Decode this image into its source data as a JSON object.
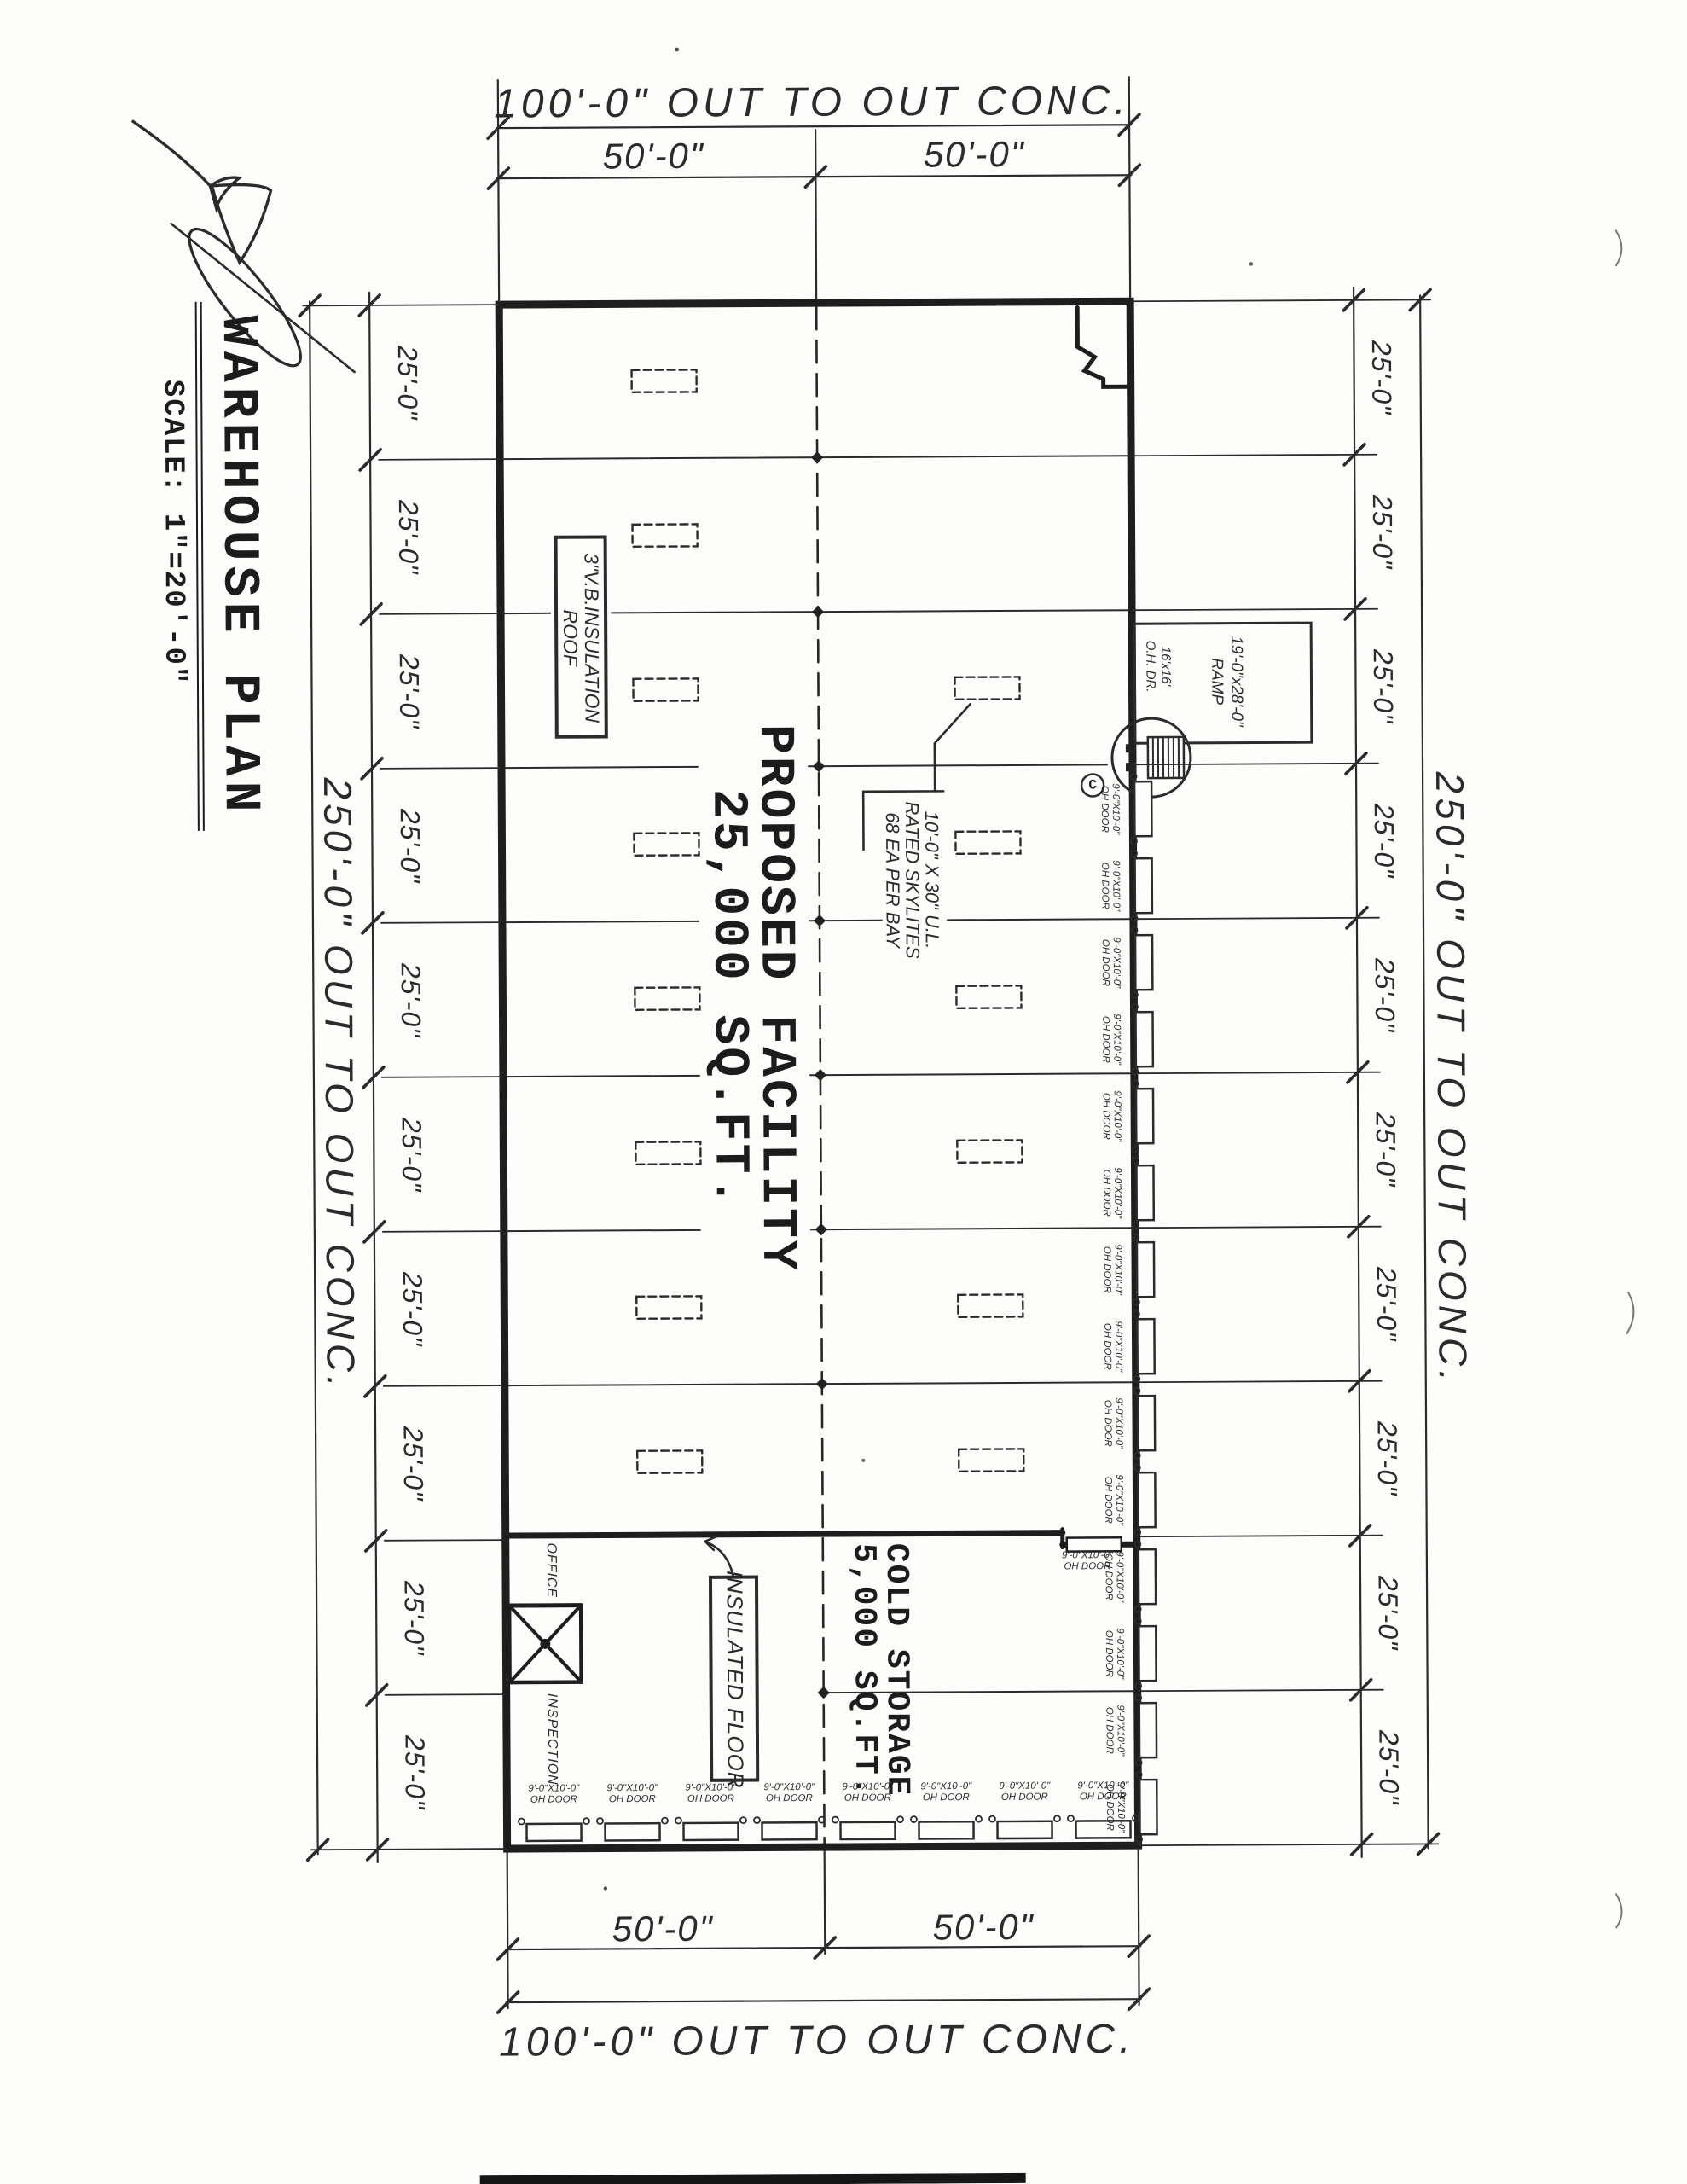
{
  "sheet": {
    "title": "WAREHOUSE PLAN",
    "scale": "SCALE: 1\"=20'-0\""
  },
  "dims": {
    "top_overall": "100'-0\" OUT TO OUT CONC.",
    "top_left_seg": "50'-0\"",
    "top_right_seg": "50'-0\"",
    "bottom_overall": "100'-0\" OUT TO OUT CONC.",
    "bottom_left_seg": "50'-0\"",
    "bottom_right_seg": "50'-0\"",
    "left_overall": "250'-0\" OUT TO OUT CONC.",
    "right_overall": "250'-0\" OUT TO OUT CONC.",
    "bay_label": "25'-0\"",
    "bay_count": 10
  },
  "plan": {
    "facility_line1": "PROPOSED FACILITY",
    "facility_line2": "25,000 SQ.FT.",
    "cold_line1": "COLD STORAGE",
    "cold_line2": "5,000 SQ.FT.",
    "office": "OFFICE",
    "inspection": "INSPECTION",
    "roof_note_line1": "3\"V.B.INSULATION",
    "roof_note_line2": "ROOF",
    "skylite_note_line1": "10'-0\" X 30\" U.L.",
    "skylite_note_line2": "RATED SKYLITES",
    "skylite_note_line3": "68 EA PER BAY",
    "insulated_floor": "INSULATED FLOOR",
    "ramp_line1": "19'-0\"x28'-0\"",
    "ramp_line2": "RAMP",
    "ohdr_line1": "16'x16'",
    "ohdr_line2": "O.H. DR.",
    "detail_bubble": "C",
    "door_line1": "9'-0\"X10'-0\"",
    "door_line2": "OH DOOR",
    "right_door_count": 14,
    "bottom_door_count": 8
  }
}
